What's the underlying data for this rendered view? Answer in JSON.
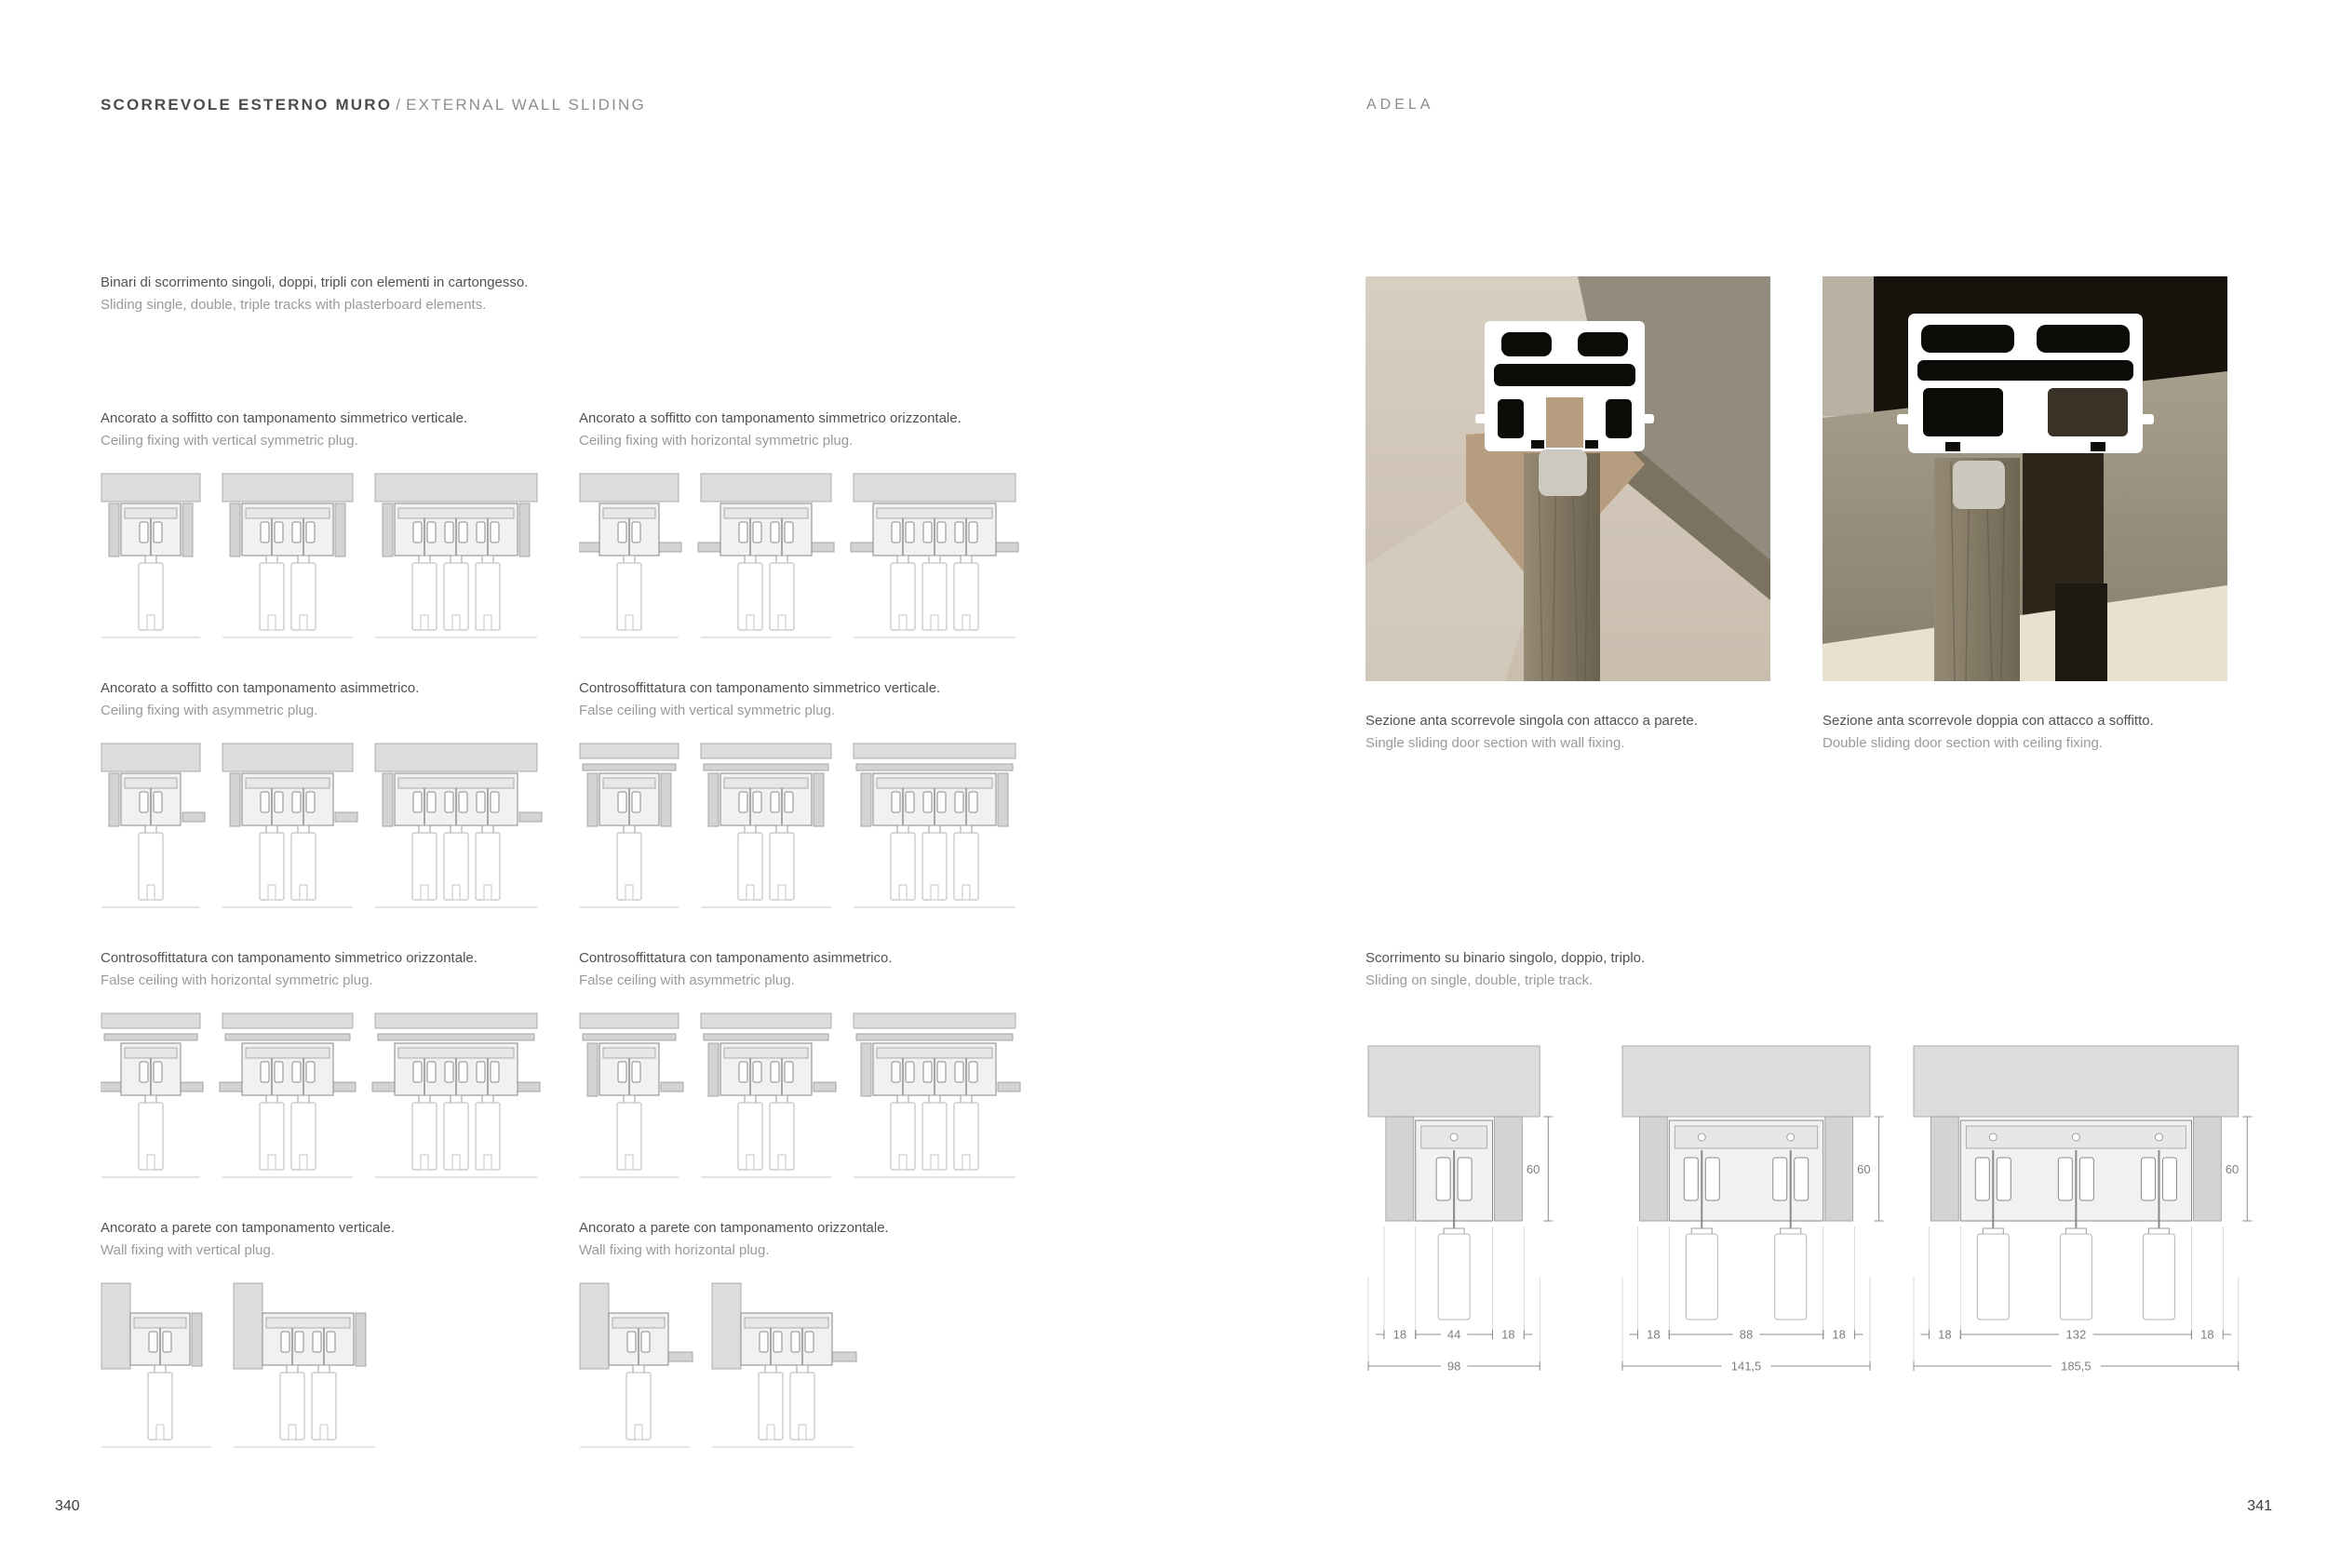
{
  "page_left": {
    "title_bold": "SCORREVOLE ESTERNO MURO",
    "title_sep": "/",
    "title_light": "EXTERNAL WALL SLIDING",
    "intro_it": "Binari di scorrimento singoli, doppi, tripli con elementi in cartongesso.",
    "intro_en": "Sliding single, double, triple tracks with plasterboard elements.",
    "page_number": "340",
    "groups": [
      {
        "caption_it": "Ancorato a soffitto con tamponamento simmetrico verticale.",
        "caption_en": "Ceiling fixing with vertical symmetric plug.",
        "top": "ceiling-vertical",
        "variants": [
          1,
          2,
          3
        ]
      },
      {
        "caption_it": "Ancorato a soffitto con tamponamento simmetrico orizzontale.",
        "caption_en": "Ceiling fixing with horizontal symmetric plug.",
        "top": "ceiling-horizontal",
        "variants": [
          1,
          2,
          3
        ]
      },
      {
        "caption_it": "Ancorato a soffitto con tamponamento asimmetrico.",
        "caption_en": "Ceiling fixing with asymmetric plug.",
        "top": "ceiling-asym",
        "variants": [
          1,
          2,
          3
        ]
      },
      {
        "caption_it": "Controsoffittatura con tamponamento simmetrico verticale.",
        "caption_en": "False ceiling with vertical symmetric plug.",
        "top": "false-vertical",
        "variants": [
          1,
          2,
          3
        ]
      },
      {
        "caption_it": "Controsoffittatura con tamponamento simmetrico orizzontale.",
        "caption_en": "False ceiling with horizontal symmetric plug.",
        "top": "false-horizontal",
        "variants": [
          1,
          2,
          3
        ]
      },
      {
        "caption_it": "Controsoffittatura con tamponamento asimmetrico.",
        "caption_en": "False ceiling with asymmetric plug.",
        "top": "false-asym",
        "variants": [
          1,
          2,
          3
        ]
      },
      {
        "caption_it": "Ancorato a parete con tamponamento verticale.",
        "caption_en": "Wall fixing with vertical plug.",
        "top": "wall-vertical",
        "variants": [
          1,
          2
        ]
      },
      {
        "caption_it": "Ancorato a parete con tamponamento orizzontale.",
        "caption_en": "Wall fixing with horizontal plug.",
        "top": "wall-horizontal",
        "variants": [
          1,
          2
        ]
      }
    ]
  },
  "page_right": {
    "brand": "ADELA",
    "page_number": "341",
    "photos": [
      {
        "caption_it": "Sezione anta scorrevole singola con attacco a parete.",
        "caption_en": "Single sliding door section with wall fixing."
      },
      {
        "caption_it": "Sezione anta scorrevole doppia con attacco a soffitto.",
        "caption_en": "Double sliding door section with ceiling fixing."
      }
    ],
    "track_section": {
      "caption_it": "Scorrimento su binario singolo, doppio, triplo.",
      "caption_en": "Sliding on single, double, triple track.",
      "drawings": [
        {
          "panels": 1,
          "dims": [
            "18",
            "44",
            "18"
          ],
          "total": "98",
          "height": "60"
        },
        {
          "panels": 2,
          "dims": [
            "18",
            "88",
            "18"
          ],
          "total": "141,5",
          "height": "60"
        },
        {
          "panels": 3,
          "dims": [
            "18",
            "132",
            "18"
          ],
          "total": "185,5",
          "height": "60"
        }
      ]
    }
  },
  "colors": {
    "accent_dark": "#4c4c4a",
    "text_gray": "#9a9a9e",
    "drawing_line": "#878787",
    "slab_fill": "#dcdcdc"
  }
}
